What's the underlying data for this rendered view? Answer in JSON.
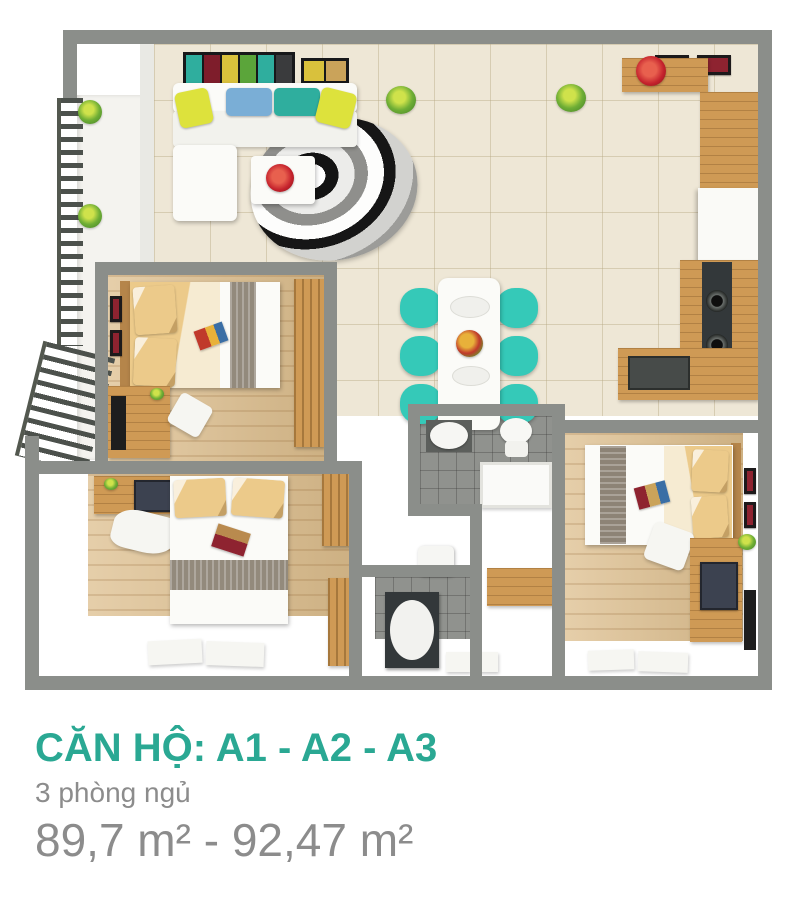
{
  "footer": {
    "title": "CĂN HỘ: A1 - A2 - A3",
    "subtitle": "3 phòng ngủ",
    "area": "89,7 m² - 92,47 m²"
  },
  "colors": {
    "accent_teal": "#2aa893",
    "text_gray": "#8c8c8c",
    "wall": "#8b8e8a",
    "chair_teal": "#35c9b8",
    "wood": "#cf9a55",
    "floor_tile": "#eee7d6",
    "floor_wood": "#ddbe8d",
    "pillow_yellow": "#dde23c",
    "flower_red": "#c5232d"
  }
}
